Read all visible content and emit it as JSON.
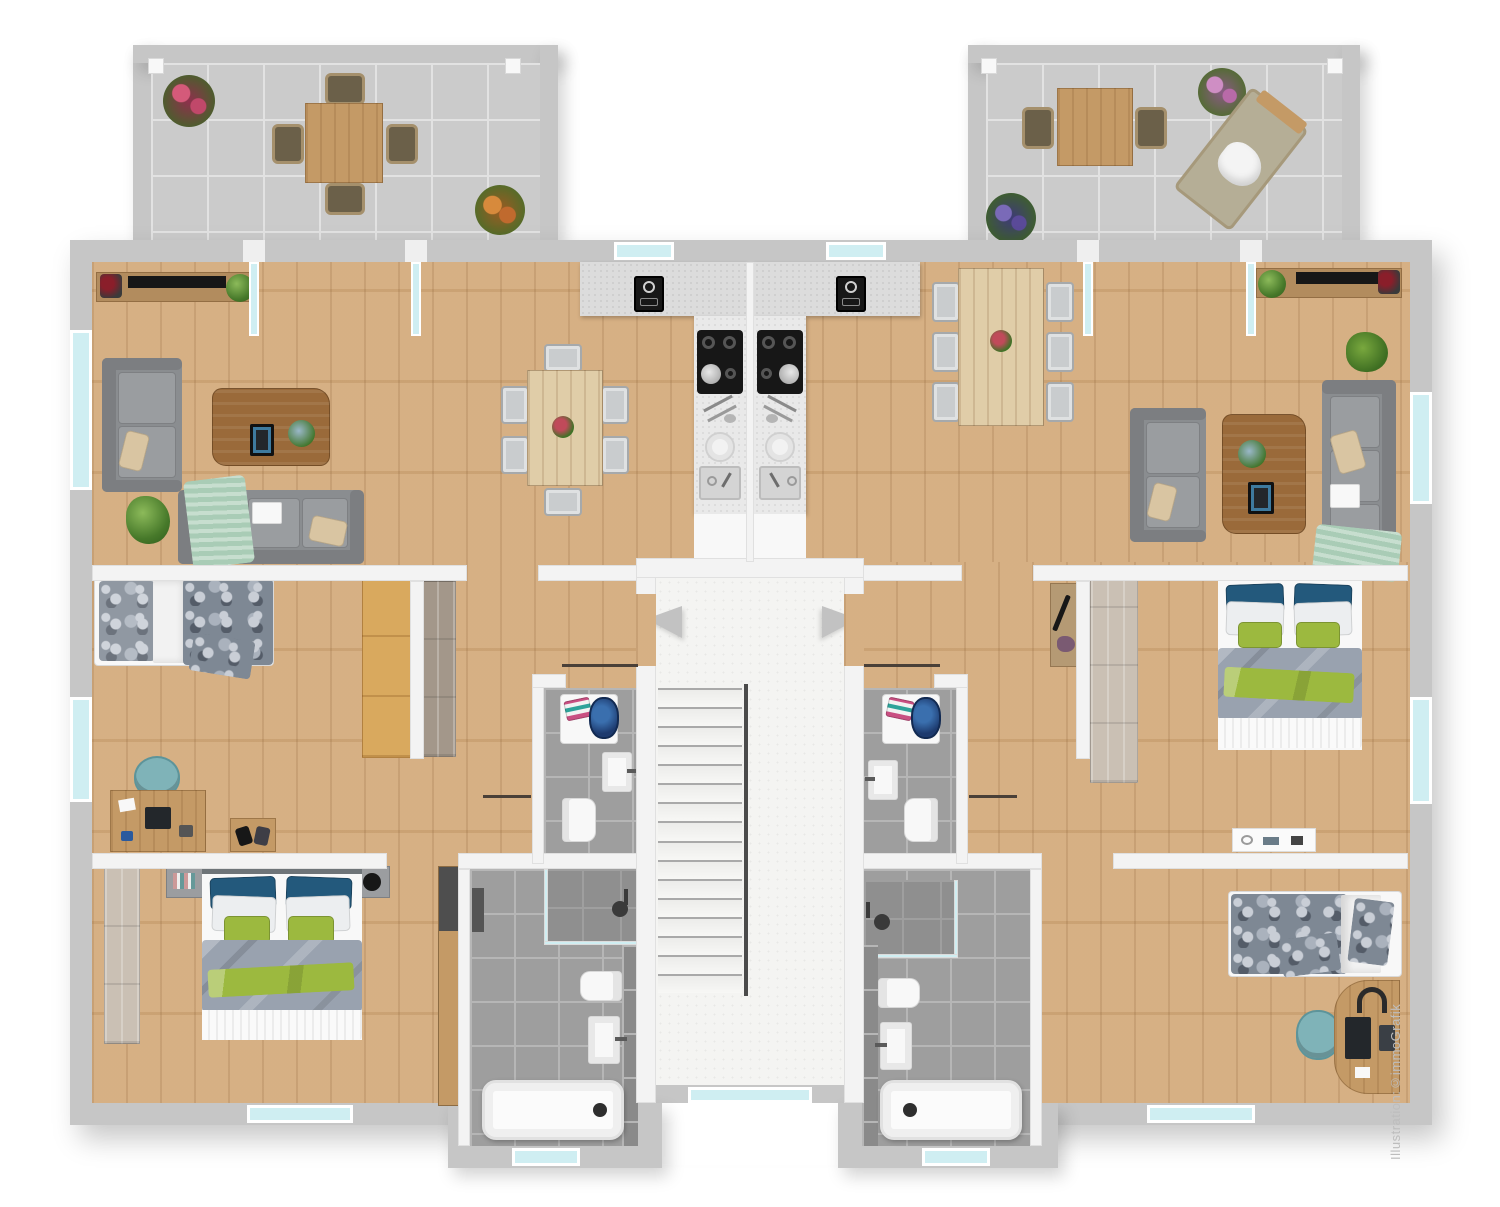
{
  "watermark": "Illustration:©immoGrafik",
  "colors": {
    "wallExt": "#c6c6c6",
    "wallInt": "#f3f3f3",
    "glass": "#cfeef2",
    "woodFloor": "#d4ab7c",
    "tileFloor": "#9e9e9e",
    "tileLine": "#b6b6b6",
    "concrete": "#cbcbcb",
    "concreteLine": "#e2e2e2",
    "stairFloor": "#f4f4f2",
    "sofa": "#8a8d90",
    "sofaCushion": "#9a9da0",
    "duvet": "#99a2af",
    "pillowBlue": "#23597c",
    "pillowGreen": "#9cb93f",
    "throwGreen": "#a9ccb6",
    "furnWood": "#c49a66",
    "furnWoodDark": "#9a6a3a",
    "furnWoodY": "#d9a95e",
    "counter": "#dcdcdc",
    "teal": "#7fb3b8",
    "wardrobeGray": "#cac0b4",
    "watermarkColor": "#bdbdbd"
  },
  "plan": {
    "title": "Upper floor plan with two mirrored apartments",
    "stairwell": {
      "treads": 16,
      "handrail": true,
      "entry_arrows": [
        "left-apartment-entry",
        "right-apartment-entry"
      ]
    },
    "terraces": [
      {
        "id": "left",
        "furniture": [
          "square dining table",
          "4 chairs",
          "red plant",
          "orange plant"
        ]
      },
      {
        "id": "right",
        "furniture": [
          "square dining table",
          "2 chairs",
          "sun lounger",
          "flower pot",
          "purple plant"
        ]
      }
    ],
    "apartments": [
      {
        "id": "left",
        "rooms": [
          {
            "name": "living-room",
            "furniture": [
              "tv sideboard",
              "2-seat sofa",
              "3-seat sofa",
              "coffee table",
              "floor plant"
            ]
          },
          {
            "name": "dining-area",
            "furniture": [
              "dining table",
              "6 chairs",
              "flower centerpiece"
            ]
          },
          {
            "name": "kitchen",
            "furniture": [
              "counter",
              "oven",
              "cooktop with pan",
              "utensils",
              "plates",
              "sink"
            ]
          },
          {
            "name": "bedroom-middle",
            "furniture": [
              "single bed",
              "desk",
              "desk chair",
              "shoe bench",
              "wardrobe"
            ]
          },
          {
            "name": "bedroom-bottom",
            "furniture": [
              "double bed",
              "2 nightstands",
              "wardrobe",
              "tall cabinet"
            ]
          },
          {
            "name": "wc",
            "furniture": [
              "washing machine",
              "laundry basket",
              "towels",
              "sink",
              "toilet"
            ]
          },
          {
            "name": "bathroom",
            "furniture": [
              "shower",
              "toilet",
              "sink",
              "bathtub"
            ]
          },
          {
            "name": "hallway",
            "furniture": [
              "sideboard"
            ]
          }
        ]
      },
      {
        "id": "right",
        "rooms": [
          {
            "name": "living-room",
            "furniture": [
              "tv sideboard",
              "2-seat sofa",
              "3-seat sofa",
              "coffee table",
              "grass plant"
            ]
          },
          {
            "name": "dining-area",
            "furniture": [
              "dining table",
              "6 chairs",
              "flower centerpiece"
            ]
          },
          {
            "name": "kitchen",
            "furniture": [
              "counter",
              "oven",
              "cooktop with pan",
              "utensils",
              "plates",
              "sink"
            ]
          },
          {
            "name": "bedroom-master",
            "furniture": [
              "double bed",
              "wardrobe",
              "vanity table"
            ]
          },
          {
            "name": "bedroom-bottom",
            "furniture": [
              "single bed",
              "curved desk",
              "desk chair",
              "headphones",
              "laptop"
            ]
          },
          {
            "name": "wc",
            "furniture": [
              "washing machine",
              "laundry basket",
              "towels",
              "sink",
              "toilet"
            ]
          },
          {
            "name": "bathroom",
            "furniture": [
              "shower",
              "toilet",
              "sink",
              "bathtub"
            ]
          },
          {
            "name": "hallway",
            "furniture": [
              "small sideboard"
            ]
          }
        ]
      }
    ]
  }
}
